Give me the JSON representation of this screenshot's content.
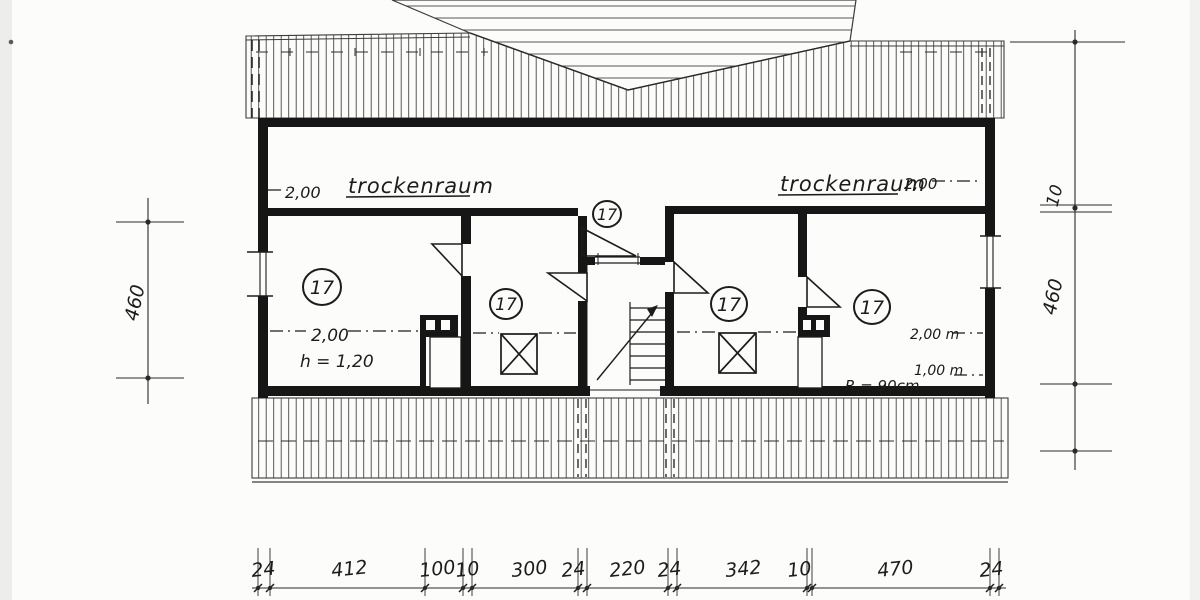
{
  "drawing": {
    "labels": {
      "strip_left_dim": "2,00",
      "strip_left_name": "trockenraum",
      "strip_right_name": "trockenraum",
      "strip_right_dim": "2,00",
      "room1_dim": "2,00",
      "room1_knee": "h = 1,20",
      "room4_dim1": "2,00 m",
      "room4_dim2": "1,00 m",
      "room4_radius": "R = 90cm",
      "room_number": "17"
    },
    "dimensions": {
      "left": "460",
      "right": [
        "10",
        "460"
      ],
      "bottom": [
        "24",
        "412",
        "100",
        "10",
        "300",
        "24",
        "220",
        "24",
        "342",
        "10",
        "470",
        "24"
      ]
    },
    "colors": {
      "ink": "#1c1c1c",
      "hatch": "#464646",
      "paper": "#fcfcfa"
    }
  }
}
